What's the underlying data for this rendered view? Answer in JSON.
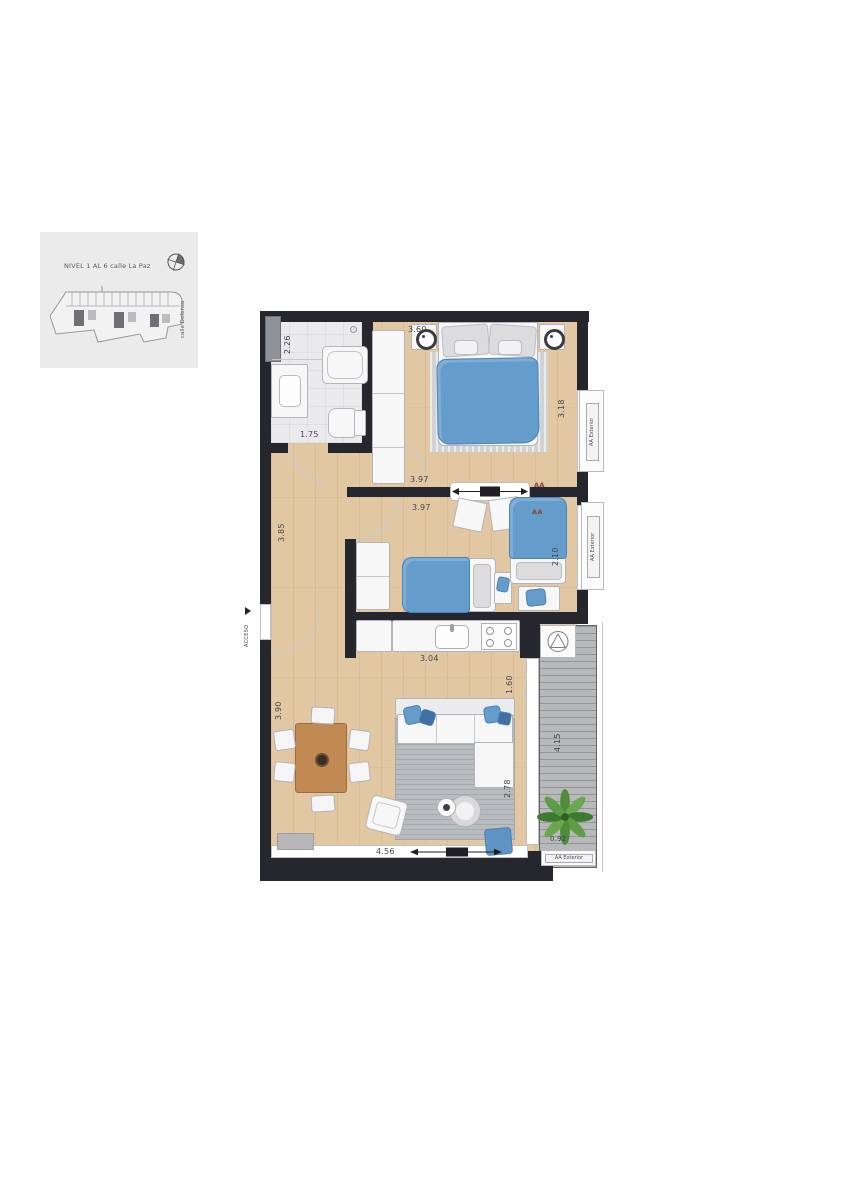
{
  "keymap": {
    "title": "NIVEL 1 AL 6 calle La Paz",
    "street": "calle Defensa"
  },
  "labels": {
    "entrance": "ACCESO",
    "ac": "AA",
    "ac_exterior": "AA Exterior"
  },
  "dims": {
    "bath_depth": "2.26",
    "bath_width": "1.75",
    "bed1_width": "3.60",
    "bed1_depth": "3.18",
    "bed1_wall": "3.97",
    "bed2_wall": "3.97",
    "hall_depth": "3.85",
    "bed2_depth": "2.10",
    "kitchen_width": "3.04",
    "kitchen_depth": "1.60",
    "living_depth": "3.90",
    "living_width": "4.56",
    "living_zone": "2.78",
    "balcony_length": "4.15",
    "balcony_width": "0.92"
  },
  "colors": {
    "wall": "#26262e",
    "wood_floor": "#e2c8a2",
    "bath_floor": "#eaeaed",
    "deck": "#b6b8ba",
    "bed_blue": "#649ccb",
    "ac_label": "#8a4436"
  }
}
